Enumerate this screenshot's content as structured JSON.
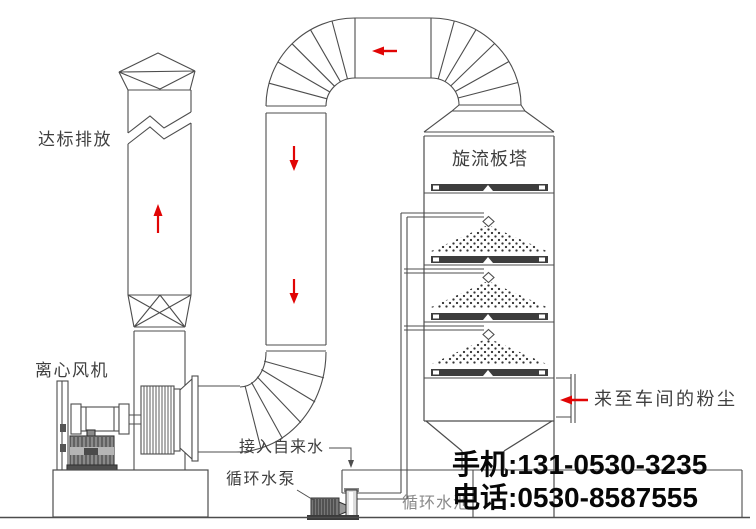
{
  "labels": {
    "emission": "达标排放",
    "tower": "旋流板塔",
    "fan": "离心风机",
    "tap_water": "接入自来水",
    "pump": "循环水泵",
    "pool": "循环水池",
    "dust_source": "来至车间的粉尘"
  },
  "contact": {
    "mobile": "手机:131-0530-3235",
    "phone": "电话:0530-8587555"
  },
  "colors": {
    "background": "#ffffff",
    "line": "#4d4d4d",
    "flow_arrow": "#e10505",
    "label_text": "#3f3f3f",
    "pool_text": "#8a8a8a",
    "contact_text": "#070707",
    "tray_fill": "#3d3d3d"
  },
  "flow_arrows": [
    {
      "id": "stack-up",
      "direction": "up",
      "color": "#e10505"
    },
    {
      "id": "duct-down-1",
      "direction": "down",
      "color": "#e10505"
    },
    {
      "id": "duct-down-2",
      "direction": "down",
      "color": "#e10505"
    },
    {
      "id": "top-duct-left",
      "direction": "left",
      "color": "#e10505"
    },
    {
      "id": "inlet-left",
      "direction": "left",
      "color": "#e10505"
    }
  ],
  "components": [
    "exhaust-stack",
    "flue-break-symbol",
    "stack-reducer",
    "centrifugal-fan",
    "fan-motor",
    "fan-impeller-housing",
    "fan-inlet-cone",
    "fan-inlet-elbow",
    "downcomer-duct",
    "upper-left-elbow",
    "top-duct",
    "upper-right-elbow",
    "tower-top-transition",
    "scrubber-tower",
    "spray-trays",
    "spray-nozzles",
    "spray-feed-pipe",
    "dust-inlet",
    "bottom-hopper",
    "water-tank",
    "circulating-pump",
    "foundation",
    "ground"
  ]
}
